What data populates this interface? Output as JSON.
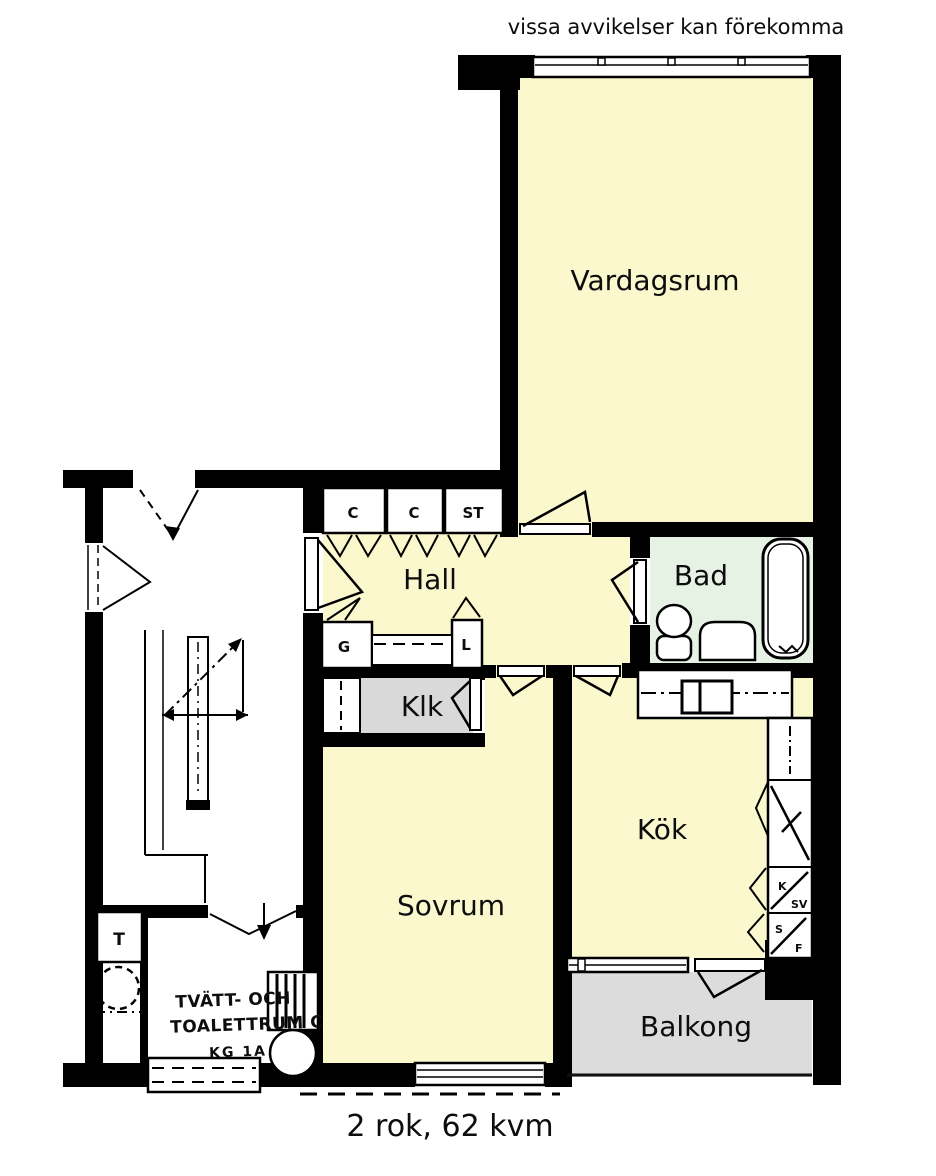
{
  "disclaimer": "vissa avvikelser kan förekomma",
  "footer": "2 rok, 62 kvm",
  "colors": {
    "room": "#FBF8CE",
    "bathroom": "#E6F2E3",
    "closet_gray": "#D9D9D9",
    "balcony_gray": "#DCDCDC",
    "wall": "#000000"
  },
  "rooms": {
    "vardagsrum": {
      "label": "Vardagsrum"
    },
    "hall": {
      "label": "Hall"
    },
    "bad": {
      "label": "Bad"
    },
    "klk": {
      "label": "Klk"
    },
    "kok": {
      "label": "Kök"
    },
    "sovrum": {
      "label": "Sovrum"
    },
    "balkong": {
      "label": "Balkong"
    }
  },
  "closets": {
    "c1": "C",
    "c2": "C",
    "st": "ST",
    "g": "G",
    "l": "L"
  },
  "appliances": {
    "kyl": {
      "top": "K",
      "bottom": "SV"
    },
    "frys": {
      "top": "S",
      "bottom": "F"
    }
  },
  "laundry": {
    "t": "T",
    "line1": "TVÄTT- OCH",
    "line2": "TOALETTRUM C",
    "line3": "KG 1A"
  }
}
